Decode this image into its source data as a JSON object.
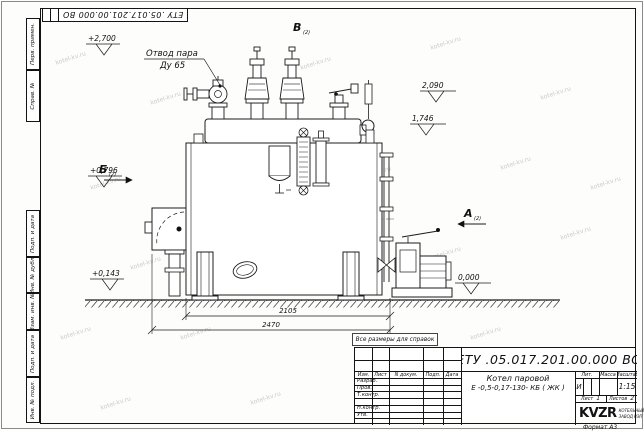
{
  "corner_stamp": {
    "doc_number": "ЕТУ .05.017.201.00.000 ВО"
  },
  "side_stamps": {
    "top": [
      "Перв. примен.",
      "Справ. №"
    ],
    "bottom": [
      "Подп. и дата",
      "Инв. № дубл.",
      "Взам. инв. №",
      "Подп. и дата",
      "Инв. № подл."
    ]
  },
  "watermark": "kotel-kv.ru",
  "drawing": {
    "reference_note": "Все размеры для справок",
    "callout": {
      "line1": "Отвод пара",
      "line2": "Ду 65"
    },
    "views": {
      "top": {
        "label": "В",
        "ref": "(2)"
      },
      "left": {
        "label": "Б",
        "ref": "(2)"
      },
      "right": {
        "label": "А",
        "ref": "(2)"
      }
    },
    "elevations": {
      "steam_outlet": "+2,700",
      "valve_top": "2,090",
      "drum_top": "1,746",
      "burner_axis": "+0,796",
      "burner_bottom": "+0,143",
      "ground": "0,000"
    },
    "dimensions": {
      "shell_length": "2105",
      "overall_length": "2470"
    }
  },
  "title_block": {
    "doc_number": "ЕТУ .05.017.201.00.000 ВО",
    "product_name": "Котел паровой",
    "product_code": "Е -0,5-0,17-130- КБ ( ЖК )",
    "columns": {
      "izm": "Изм.",
      "list": "Лист",
      "doc": "N докум.",
      "podp": "Подп.",
      "data": "Дата"
    },
    "rows": {
      "razrab": "Разраб.",
      "prov": "Пров.",
      "tkontr": "Т.контр.",
      "nkontr": "Н.контр.",
      "utv": "Утв."
    },
    "lit_header": "Лит.",
    "lit_value": "И",
    "mass_header": "Масса",
    "scale_header": "Масштаб",
    "scale_value": "1:15",
    "sheet_header": "Лист",
    "sheet_value": "1",
    "sheets_header": "Листов",
    "sheets_value": "2",
    "logo_text": "KVZR",
    "company": {
      "line1": "КОТЕЛЬНЫЙ",
      "line2": "ЗАВОД РЭП"
    },
    "format_note": "Формат А3"
  }
}
